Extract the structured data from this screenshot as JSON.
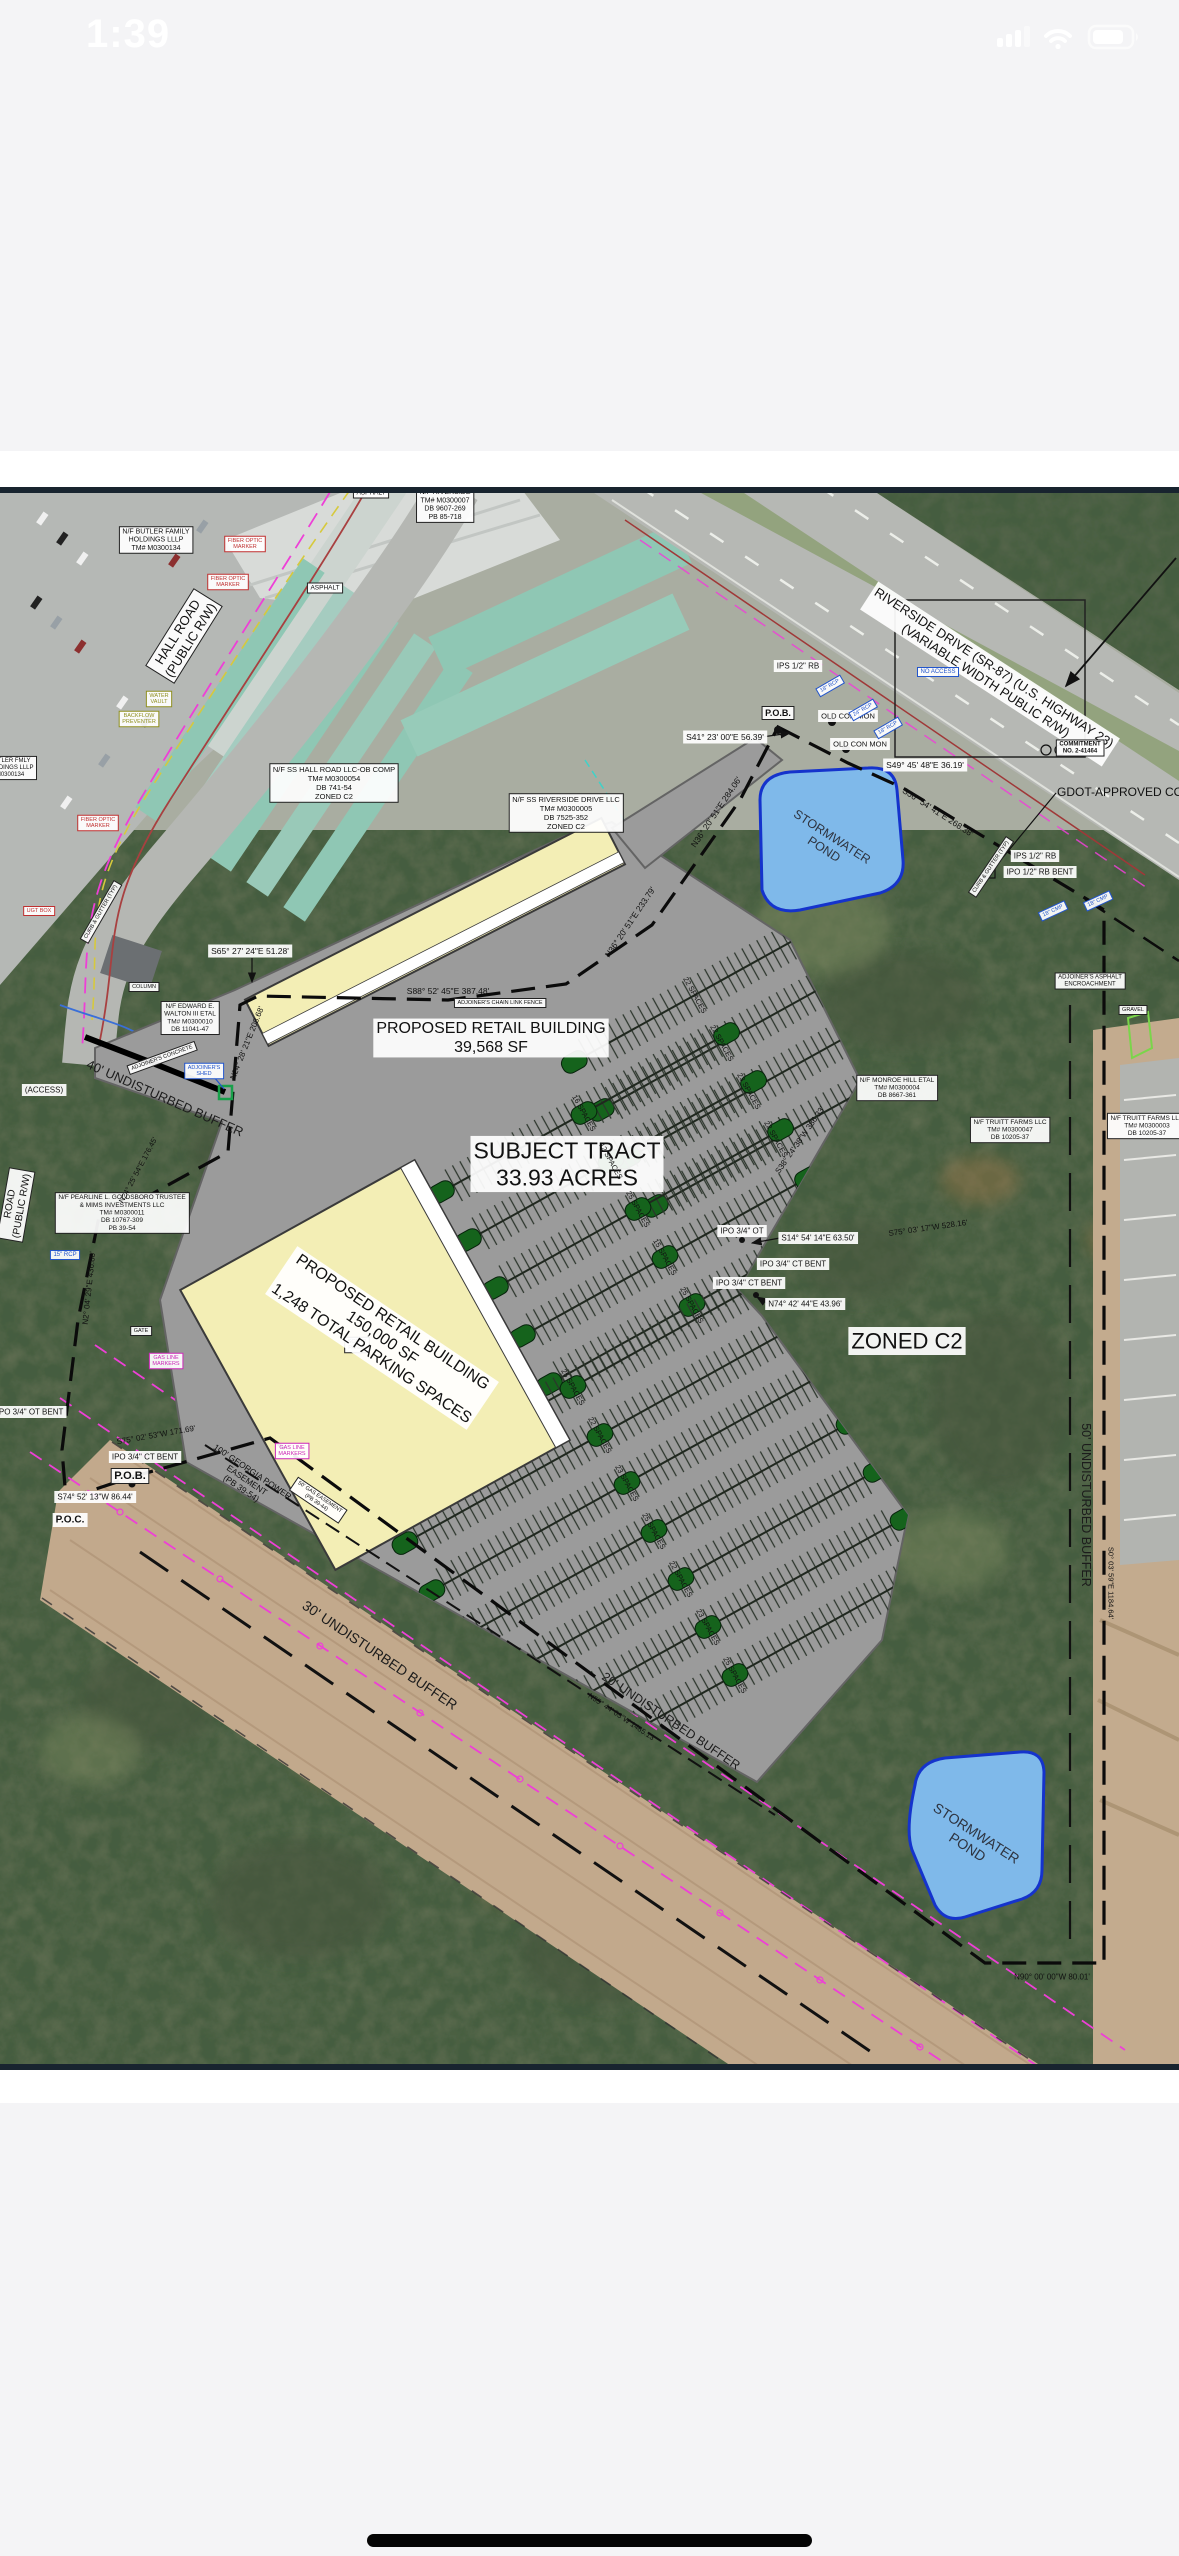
{
  "status_bar": {
    "time": "1:39"
  },
  "home_indicator": {},
  "colors": {
    "page_bg": "#f4f4f6",
    "plan_border": "#18242f",
    "pond_fill": "#7fb9ea",
    "pond_stroke": "#1533cc",
    "building_fill": "#f3eeb5",
    "parking_fill": "#9b9b9b",
    "island_green": "#15631c",
    "gas_magenta": "#ee3fd7",
    "boundary": "#0b0b0b",
    "trees": "#5f6d51",
    "easement_tan": "#c2a98c"
  },
  "plan": {
    "labels": [
      {
        "n": "riverside-parcel-top",
        "t": [
          "N/F RIVERSIDE",
          "TM# M0300007",
          "DB 9607-269",
          "PB 85-718"
        ],
        "x": 445,
        "y": 505,
        "fs": 7,
        "box": 2
      },
      {
        "n": "butler-parcel",
        "t": [
          "N/F BUTLER FAMILY",
          "HOLDINGS LLLP",
          "TM# M0300134"
        ],
        "x": 156,
        "y": 540,
        "fs": 7,
        "box": 2
      },
      {
        "n": "butler-parcel-2",
        "t": [
          "BUTLER FMLY",
          "HOLDINGS LLLP",
          "M0300134"
        ],
        "x": 10,
        "y": 768,
        "fs": 6,
        "box": 2
      },
      {
        "n": "asphalt-1",
        "t": "ASPHALT",
        "x": 371,
        "y": 493,
        "fs": 6.5,
        "box": 2
      },
      {
        "n": "asphalt-2",
        "t": "ASPHALT",
        "x": 325,
        "y": 588,
        "fs": 6.5,
        "box": 2
      },
      {
        "n": "fiber-optic-1",
        "t": [
          "FIBER OPTIC",
          "MARKER"
        ],
        "x": 245,
        "y": 544,
        "fs": 5.5,
        "box": 2,
        "c": "#c03030"
      },
      {
        "n": "fiber-optic-2",
        "t": [
          "FIBER OPTIC",
          "MARKER"
        ],
        "x": 228,
        "y": 582,
        "fs": 5.5,
        "box": 2,
        "c": "#c03030"
      },
      {
        "n": "fiber-optic-3",
        "t": [
          "FIBER OPTIC",
          "MARKER"
        ],
        "x": 98,
        "y": 823,
        "fs": 5.5,
        "box": 2,
        "c": "#c03030"
      },
      {
        "n": "hall-road",
        "t": [
          "HALL ROAD",
          "(PUBLIC R/W)"
        ],
        "x": 184,
        "y": 636,
        "r": -58,
        "fs": 13,
        "box": 2
      },
      {
        "n": "water-vault",
        "t": [
          "WATER",
          "VAULT"
        ],
        "x": 159,
        "y": 699,
        "fs": 5.5,
        "box": 2,
        "c": "#8f8f20"
      },
      {
        "n": "backflow-preventer",
        "t": [
          "BACKFLOW",
          "PREVENTER"
        ],
        "x": 139,
        "y": 719,
        "fs": 5.5,
        "box": 2,
        "c": "#8f8f20"
      },
      {
        "n": "curb-gutter-1",
        "t": "CURB & GUTTER (TYP)",
        "x": 101,
        "y": 912,
        "r": -60,
        "fs": 5.5,
        "box": 2
      },
      {
        "n": "ss-hall-parcel",
        "t": [
          "N/F SS HALL ROAD LLC-OB COMP",
          "TM# M0300054",
          "DB 741-54",
          "ZONED C2"
        ],
        "x": 334,
        "y": 783,
        "fs": 7.5,
        "box": 2
      },
      {
        "n": "ugt-box",
        "t": "UGT BOX",
        "x": 39,
        "y": 911,
        "fs": 5.5,
        "box": 2,
        "c": "#c03030"
      },
      {
        "n": "ss-riverside-parcel",
        "t": [
          "N/F SS RIVERSIDE DRIVE LLC",
          "TM# M0300005",
          "DB 7525-352",
          "ZONED C2"
        ],
        "x": 566,
        "y": 813,
        "fs": 7.5,
        "box": 2
      },
      {
        "n": "riverside-drive",
        "t": [
          "RIVERSIDE DRIVE (SR-87) (U.S. HIGHWAY 23)",
          "(VARIABLE WIDTH PUBLIC R/W)"
        ],
        "x": 990,
        "y": 674,
        "r": 33,
        "fs": 13,
        "box": 1
      },
      {
        "n": "commitment",
        "t": [
          "COMMITMENT",
          "NO. 2-41464"
        ],
        "x": 1080,
        "y": 748,
        "fs": 6,
        "box": 2,
        "b": 1
      },
      {
        "n": "gdot-approved",
        "t": "GDOT-APPROVED COMMI",
        "x": 1057,
        "y": 792,
        "fs": 12,
        "a": "start"
      },
      {
        "n": "no-access",
        "t": "NO ACCESS",
        "x": 938,
        "y": 672,
        "fs": 6,
        "box": 2,
        "c": "#2255cc"
      },
      {
        "n": "ips-rb-1",
        "t": "IPS 1/2\" RB",
        "x": 798,
        "y": 666,
        "fs": 8,
        "box": 1
      },
      {
        "n": "pob-top",
        "t": "P.O.B.",
        "x": 778,
        "y": 713,
        "fs": 9,
        "box": 2,
        "b": 1
      },
      {
        "n": "old-con-mon-1",
        "t": "OLD CON MON",
        "x": 848,
        "y": 716,
        "fs": 7.5,
        "box": 1
      },
      {
        "n": "old-con-mon-2",
        "t": "OLD CON MON",
        "x": 860,
        "y": 744,
        "fs": 7.5,
        "box": 1
      },
      {
        "n": "bearing-s41",
        "t": "S41° 23' 00\"E   56.39'",
        "x": 725,
        "y": 737,
        "fs": 8.5,
        "box": 1
      },
      {
        "n": "bearing-s49",
        "t": "S49° 45' 48\"E   36.19'",
        "x": 925,
        "y": 765,
        "fs": 8.5,
        "box": 1
      },
      {
        "n": "bearing-s56",
        "t": "S56° 54' 41\"E   268.38'",
        "x": 938,
        "y": 812,
        "r": 33,
        "fs": 8.5
      },
      {
        "n": "rcp-18-1",
        "t": "18\" RCP",
        "x": 830,
        "y": 686,
        "r": -30,
        "fs": 5.5,
        "box": 2,
        "c": "#2255cc"
      },
      {
        "n": "rcp-24",
        "t": "24\" RCP",
        "x": 863,
        "y": 710,
        "r": -30,
        "fs": 5.5,
        "box": 2,
        "c": "#2255cc"
      },
      {
        "n": "rcp-18-2",
        "t": "18\" RCP",
        "x": 888,
        "y": 728,
        "r": -30,
        "fs": 5.5,
        "box": 2,
        "c": "#2255cc"
      },
      {
        "n": "stormwater-pond-top",
        "t": [
          "STORMWATER",
          "POND"
        ],
        "x": 828,
        "y": 843,
        "r": 33,
        "fs": 12.5,
        "c": "#2e3440"
      },
      {
        "n": "bearing-n36-284",
        "t": "N36° 20' 51\"E   284.06'",
        "x": 716,
        "y": 812,
        "r": -56,
        "fs": 8.5
      },
      {
        "n": "curb-gutter-2",
        "t": "CURB & GUTTER (TYP)",
        "x": 991,
        "y": 867,
        "r": -56,
        "fs": 5.5,
        "box": 2
      },
      {
        "n": "ips-rb-2",
        "t": "IPS 1/2\" RB",
        "x": 1035,
        "y": 856,
        "fs": 8,
        "box": 1
      },
      {
        "n": "ipo-rb-bent",
        "t": "IPO 1/2\" RB BENT",
        "x": 1040,
        "y": 872,
        "fs": 8,
        "box": 1
      },
      {
        "n": "cmp-18-1",
        "t": "18\" CMP",
        "x": 1053,
        "y": 911,
        "r": -25,
        "fs": 5.5,
        "box": 2,
        "c": "#2255cc"
      },
      {
        "n": "cmp-18-2",
        "t": "18\" CMP",
        "x": 1098,
        "y": 901,
        "r": -25,
        "fs": 5.5,
        "box": 2,
        "c": "#2255cc"
      },
      {
        "n": "adjoiner-asphalt",
        "t": [
          "ADJOINER'S ASPHALT",
          "ENCROACHMENT"
        ],
        "x": 1090,
        "y": 981,
        "fs": 6,
        "box": 2
      },
      {
        "n": "gravel",
        "t": "GRAVEL",
        "x": 1133,
        "y": 1010,
        "fs": 5.5,
        "box": 2
      },
      {
        "n": "bearing-s65",
        "t": "S65° 27' 24\"E   51.28'",
        "x": 250,
        "y": 951,
        "fs": 8.5,
        "box": 1
      },
      {
        "n": "bearing-s88",
        "t": "S88° 52' 45\"E   387.48'",
        "x": 448,
        "y": 991,
        "fs": 8.5
      },
      {
        "n": "adjoiner-fence",
        "t": "ADJOINER'S CHAIN LINK FENCE",
        "x": 500,
        "y": 1003,
        "fs": 5.5,
        "box": 2
      },
      {
        "n": "bearing-n36-233",
        "t": "N36° 20' 51\"E   233.79'",
        "x": 630,
        "y": 922,
        "r": -56,
        "fs": 8.5
      },
      {
        "n": "retail-building-1",
        "t": [
          "PROPOSED RETAIL BUILDING",
          "39,568 SF"
        ],
        "x": 491,
        "y": 1038,
        "fs": 16,
        "box": 1
      },
      {
        "n": "walton-parcel",
        "t": [
          "N/F EDWARD E.",
          "WALTON III ETAL",
          "TM# M0300010",
          "DB 11041-47"
        ],
        "x": 190,
        "y": 1018,
        "fs": 6.5,
        "box": 2
      },
      {
        "n": "column",
        "t": "COLUMN",
        "x": 144,
        "y": 987,
        "fs": 5.5,
        "box": 2
      },
      {
        "n": "adjoiner-concrete",
        "t": "ADJOINER'S CONCRETE",
        "x": 162,
        "y": 1058,
        "r": -20,
        "fs": 5.5,
        "box": 2
      },
      {
        "n": "adjoiner-shed",
        "t": [
          "ADJOINER'S",
          "SHED"
        ],
        "x": 204,
        "y": 1071,
        "fs": 5.5,
        "box": 2,
        "c": "#2255cc"
      },
      {
        "n": "bearing-n24-208",
        "t": "N24° 28' 21\"E   208.68'",
        "x": 247,
        "y": 1043,
        "r": -68,
        "fs": 8
      },
      {
        "n": "buffer-40",
        "t": "40' UNDISTURBED BUFFER",
        "x": 165,
        "y": 1098,
        "r": 24,
        "fs": 13,
        "c": "#1c1c1c"
      },
      {
        "n": "access",
        "t": "(ACCESS)",
        "x": 44,
        "y": 1090,
        "fs": 8,
        "box": 1
      },
      {
        "n": "road-left",
        "t": [
          "ROAD",
          "(PUBLIC R/W)"
        ],
        "x": 16,
        "y": 1205,
        "r": -80,
        "fs": 10,
        "box": 2
      },
      {
        "n": "subject-tract",
        "t": [
          "SUBJECT TRACT",
          "33.93 ACRES"
        ],
        "x": 567,
        "y": 1164,
        "fs": 23,
        "box": 1
      },
      {
        "n": "monroe-parcel",
        "t": [
          "N/F MONROE HILL ETAL",
          "TM# M0300004",
          "DB 8667-361"
        ],
        "x": 897,
        "y": 1088,
        "fs": 6.5,
        "box": 2
      },
      {
        "n": "truitt-parcel-1",
        "t": [
          "N/F TRUITT FARMS LLC",
          "TM# M0300047",
          "DB 10205-37"
        ],
        "x": 1010,
        "y": 1130,
        "fs": 6.5,
        "box": 2
      },
      {
        "n": "truitt-parcel-2",
        "t": [
          "N/F TRUITT FARMS LLC",
          "TM# M0300003",
          "DB 10205-37"
        ],
        "x": 1147,
        "y": 1126,
        "fs": 6.5,
        "box": 2
      },
      {
        "n": "bearing-s38",
        "t": "S38° 24' 38\"W   386.33'",
        "x": 800,
        "y": 1140,
        "r": -55,
        "fs": 8
      },
      {
        "n": "ipo-ot",
        "t": "IPO 3/4\" OT",
        "x": 742,
        "y": 1231,
        "fs": 8,
        "box": 1
      },
      {
        "n": "bearing-s14",
        "t": "S14° 54' 14\"E   63.50'",
        "x": 818,
        "y": 1238,
        "fs": 8,
        "box": 1
      },
      {
        "n": "ipo-ct-bent-1",
        "t": "IPO 3/4\" CT BENT",
        "x": 793,
        "y": 1264,
        "fs": 8,
        "box": 1
      },
      {
        "n": "ipo-ct-bent-2",
        "t": "IPO 3/4\" CT BENT",
        "x": 749,
        "y": 1283,
        "fs": 8,
        "box": 1
      },
      {
        "n": "bearing-n74",
        "t": "N74° 42' 44\"E   43.96'",
        "x": 805,
        "y": 1304,
        "fs": 8,
        "box": 1
      },
      {
        "n": "bearing-s75-528",
        "t": "S75° 03' 17\"W   528.16'",
        "x": 928,
        "y": 1228,
        "r": -8,
        "fs": 8
      },
      {
        "n": "zoned-c2",
        "t": "ZONED C2",
        "x": 907,
        "y": 1341,
        "fs": 22,
        "box": 1
      },
      {
        "n": "pearline-parcel",
        "t": [
          "N/F PEARLINE L. GOLDSBORO TRUSTEE",
          "& MIMS INVESTMENTS LLC",
          "TM# M0300011",
          "DB 10767-309",
          "PB 39-54"
        ],
        "x": 122,
        "y": 1213,
        "fs": 6.5,
        "box": 2
      },
      {
        "n": "rcp-15",
        "t": "15\" RCP",
        "x": 65,
        "y": 1255,
        "fs": 6,
        "box": 2,
        "c": "#2255cc"
      },
      {
        "n": "bearing-n2",
        "t": "N2° 04' 29\"E   436.80'",
        "x": 89,
        "y": 1288,
        "r": -84,
        "fs": 8
      },
      {
        "n": "gate",
        "t": "GATE",
        "x": 141,
        "y": 1331,
        "fs": 5.5,
        "box": 2
      },
      {
        "n": "gas-markers-1",
        "t": [
          "GAS LINE",
          "MARKERS"
        ],
        "x": 166,
        "y": 1361,
        "fs": 5.5,
        "box": 2,
        "c": "#cc28b8"
      },
      {
        "n": "solar-panel",
        "t": [
          "SOLAR",
          "PANEL"
        ],
        "x": 357,
        "y": 1345,
        "fs": 5.5,
        "box": 2
      },
      {
        "n": "retail-building-2",
        "t": [
          "PROPOSED RETAIL BUILDING",
          "150,000 SF",
          "1,248 TOTAL PARKING SPACES"
        ],
        "x": 382,
        "y": 1338,
        "r": 34,
        "fs": 16,
        "box": 1
      },
      {
        "n": "ipo-ot-bent-left",
        "t": "IPO 3/4\" OT BENT",
        "x": 30,
        "y": 1412,
        "fs": 8,
        "box": 1
      },
      {
        "n": "bearing-n24-176",
        "t": "N24° 25' 54\"E   176.45'",
        "x": 138,
        "y": 1170,
        "r": -62,
        "fs": 7.5
      },
      {
        "n": "bearing-s75-171",
        "t": "S75° 02' 53\"W   171.69'",
        "x": 156,
        "y": 1435,
        "r": -10,
        "fs": 8
      },
      {
        "n": "ipo-ct-bent-3",
        "t": "IPO 3/4\" CT BENT",
        "x": 145,
        "y": 1457,
        "fs": 8,
        "box": 1
      },
      {
        "n": "pob-bottom",
        "t": "P.O.B.",
        "x": 130,
        "y": 1476,
        "fs": 11,
        "box": 2,
        "b": 1
      },
      {
        "n": "bearing-s74",
        "t": "S74° 52' 13\"W   86.44'",
        "x": 95,
        "y": 1497,
        "fs": 8,
        "box": 1
      },
      {
        "n": "poc",
        "t": "P.O.C.",
        "x": 70,
        "y": 1520,
        "fs": 10,
        "box": 1,
        "b": 1
      },
      {
        "n": "georgia-power-easement",
        "t": [
          "100' GEORGIA POWER",
          "EASEMENT",
          "(PB 39-54)"
        ],
        "x": 247,
        "y": 1480,
        "r": 34,
        "fs": 8.5
      },
      {
        "n": "gas-markers-2",
        "t": [
          "GAS LINE",
          "MARKERS"
        ],
        "x": 292,
        "y": 1451,
        "fs": 5.5,
        "box": 2,
        "c": "#cc28b8"
      },
      {
        "n": "gas-easement",
        "t": [
          "50' GAS EASEMENT",
          "(PB 39-44)"
        ],
        "x": 318,
        "y": 1500,
        "r": 34,
        "fs": 5.5,
        "box": 2
      },
      {
        "n": "buffer-30",
        "t": "30' UNDISTURBED BUFFER",
        "x": 380,
        "y": 1655,
        "r": 34,
        "fs": 14,
        "c": "#1c1c1c"
      },
      {
        "n": "buffer-20",
        "t": "20' UNDISTURBED BUFFER",
        "x": 671,
        "y": 1721,
        "r": 34,
        "fs": 12.5,
        "c": "#1c1c1c"
      },
      {
        "n": "bearing-n55",
        "t": "N55° 44' 03\"W   1485.13'",
        "x": 622,
        "y": 1717,
        "r": 34,
        "fs": 7.5
      },
      {
        "n": "buffer-50",
        "t": "50' UNDISTURBED BUFFER",
        "x": 1086,
        "y": 1505,
        "r": 90,
        "fs": 12.5,
        "c": "#1c1c1c"
      },
      {
        "n": "bearing-s0",
        "t": "S0° 03' 59\"E   1184.64'",
        "x": 1111,
        "y": 1583,
        "r": 90,
        "fs": 7.5
      },
      {
        "n": "stormwater-pond-bottom",
        "t": [
          "STORMWATER",
          "POND"
        ],
        "x": 972,
        "y": 1840,
        "r": 33,
        "fs": 14,
        "c": "#2e3440"
      },
      {
        "n": "bearing-n90",
        "t": "N90° 00' 00\"W   80.01'",
        "x": 1052,
        "y": 1977,
        "fs": 8
      },
      {
        "n": "spaces-1",
        "t": "22 SPACES",
        "x": 695,
        "y": 995,
        "r": 61,
        "fs": 7.5
      },
      {
        "n": "spaces-2",
        "t": "22 SPACES",
        "x": 722,
        "y": 1043,
        "r": 61,
        "fs": 7.5
      },
      {
        "n": "spaces-3",
        "t": "23 SPACES",
        "x": 749,
        "y": 1091,
        "r": 61,
        "fs": 7.5
      },
      {
        "n": "spaces-4",
        "t": "22 SPACES",
        "x": 776,
        "y": 1139,
        "r": 61,
        "fs": 7.5
      },
      {
        "n": "spaces-5",
        "t": "16 SPACES",
        "x": 584,
        "y": 1113,
        "r": 61,
        "fs": 7.5
      },
      {
        "n": "spaces-6",
        "t": "12 SPACES",
        "x": 611,
        "y": 1161,
        "r": 61,
        "fs": 7.5
      },
      {
        "n": "spaces-7",
        "t": "25 SPACES",
        "x": 638,
        "y": 1209,
        "r": 61,
        "fs": 7.5
      },
      {
        "n": "spaces-8",
        "t": "15 SPACES",
        "x": 665,
        "y": 1257,
        "r": 61,
        "fs": 7.5
      },
      {
        "n": "spaces-9",
        "t": "25 SPACES",
        "x": 692,
        "y": 1305,
        "r": 61,
        "fs": 7.5
      },
      {
        "n": "spaces-10",
        "t": "25 SPACES",
        "x": 573,
        "y": 1387,
        "r": 61,
        "fs": 7.5
      },
      {
        "n": "spaces-11",
        "t": "22 SPACES",
        "x": 600,
        "y": 1435,
        "r": 61,
        "fs": 7.5
      },
      {
        "n": "spaces-12",
        "t": "23 SPACES",
        "x": 627,
        "y": 1483,
        "r": 61,
        "fs": 7.5
      },
      {
        "n": "spaces-13",
        "t": "25 SPACES",
        "x": 654,
        "y": 1531,
        "r": 61,
        "fs": 7.5
      },
      {
        "n": "spaces-14",
        "t": "22 SPACES",
        "x": 681,
        "y": 1579,
        "r": 61,
        "fs": 7.5
      },
      {
        "n": "spaces-15",
        "t": "23 SPACES",
        "x": 708,
        "y": 1627,
        "r": 61,
        "fs": 7.5
      },
      {
        "n": "spaces-16",
        "t": "25 SPACES",
        "x": 735,
        "y": 1675,
        "r": 61,
        "fs": 7.5
      }
    ]
  }
}
